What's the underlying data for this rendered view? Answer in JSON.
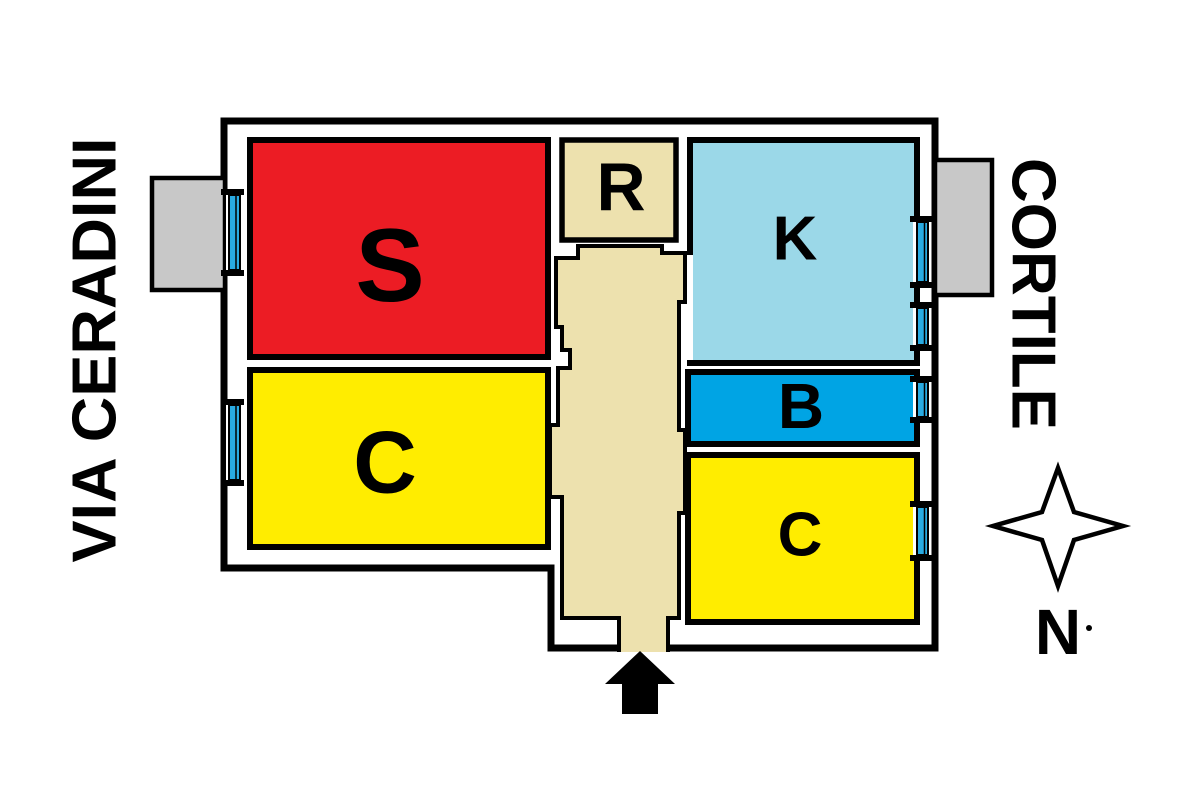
{
  "streets": {
    "left": "VIA CERADINI",
    "right": "CORTILE"
  },
  "compass": {
    "label": "N"
  },
  "rooms": [
    {
      "id": "s",
      "label": "S",
      "color": "#EC1C24"
    },
    {
      "id": "c_left",
      "label": "C",
      "color": "#FFED00"
    },
    {
      "id": "r",
      "label": "R",
      "color": "#EDE1AE"
    },
    {
      "id": "k",
      "label": "K",
      "color": "#9BD8E8"
    },
    {
      "id": "b",
      "label": "B",
      "color": "#00A4E4"
    },
    {
      "id": "c_right",
      "label": "C",
      "color": "#FFED00"
    }
  ],
  "colors": {
    "background": "#FFFFFF",
    "wall": "#000000",
    "corridor": "#EDE1AE",
    "balcony": "#C8C8C8",
    "window": "#29ABE2"
  },
  "icons": {
    "compass_star": "four-point-star",
    "entrance_arrow": "up-arrow",
    "window_marker": "blue-double-pane-bar",
    "balcony_marker": "grey-rectangle"
  }
}
